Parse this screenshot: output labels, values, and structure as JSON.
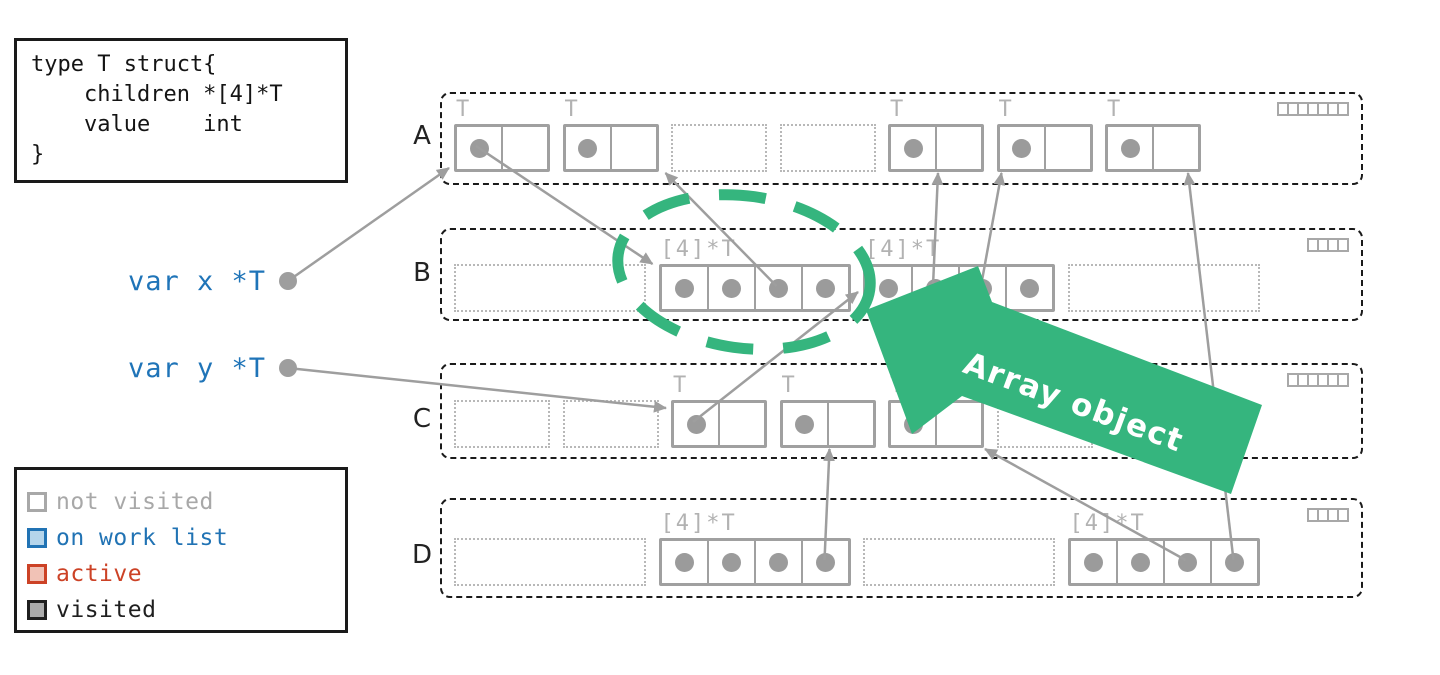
{
  "code_box": {
    "lines": [
      "type T struct{",
      "    children *[4]*T",
      "    value    int",
      "}"
    ]
  },
  "variables": [
    {
      "label": "var x *T"
    },
    {
      "label": "var y *T"
    }
  ],
  "legend": {
    "items": [
      {
        "label": "not visited",
        "box_border": "#a8a8a8",
        "box_fill": "#ffffff",
        "text_color": "#a8a8a8"
      },
      {
        "label": "on work list",
        "box_border": "#2173b4",
        "box_fill": "#b5d5eb",
        "text_color": "#2173b4"
      },
      {
        "label": "active",
        "box_border": "#cc4226",
        "box_fill": "#f1c2b6",
        "text_color": "#cc4226"
      },
      {
        "label": "visited",
        "box_border": "#1f1f1f",
        "box_fill": "#ababab",
        "text_color": "#1f1f1f"
      }
    ]
  },
  "heap": {
    "regions": [
      {
        "name": "A",
        "bitmap_cells": 7,
        "slots": [
          {
            "kind": "object",
            "type_label": "T",
            "cells": 2,
            "pointers": [
              0
            ]
          },
          {
            "kind": "object",
            "type_label": "T",
            "cells": 2,
            "pointers": [
              0
            ]
          },
          {
            "kind": "free",
            "cells": 2
          },
          {
            "kind": "free",
            "cells": 2
          },
          {
            "kind": "object",
            "type_label": "T",
            "cells": 2,
            "pointers": [
              0
            ]
          },
          {
            "kind": "object",
            "type_label": "T",
            "cells": 2,
            "pointers": [
              0
            ]
          },
          {
            "kind": "object",
            "type_label": "T",
            "cells": 2,
            "pointers": [
              0
            ]
          }
        ]
      },
      {
        "name": "B",
        "bitmap_cells": 4,
        "slots": [
          {
            "kind": "free",
            "cells": 4
          },
          {
            "kind": "object",
            "type_label": "[4]*T",
            "cells": 4,
            "pointers": [
              0,
              1,
              2,
              3
            ]
          },
          {
            "kind": "object",
            "type_label": "[4]*T",
            "cells": 4,
            "pointers": [
              0,
              1,
              2,
              3
            ]
          },
          {
            "kind": "free",
            "cells": 4
          }
        ]
      },
      {
        "name": "C",
        "bitmap_cells": 6,
        "slots": [
          {
            "kind": "free",
            "cells": 2
          },
          {
            "kind": "free",
            "cells": 2
          },
          {
            "kind": "object",
            "type_label": "T",
            "cells": 2,
            "pointers": [
              0
            ]
          },
          {
            "kind": "object",
            "type_label": "T",
            "cells": 2,
            "pointers": [
              0
            ]
          },
          {
            "kind": "object",
            "type_label": "T",
            "cells": 2,
            "pointers": [
              0
            ]
          },
          {
            "kind": "free",
            "cells": 2
          }
        ]
      },
      {
        "name": "D",
        "bitmap_cells": 4,
        "slots": [
          {
            "kind": "free",
            "cells": 4
          },
          {
            "kind": "object",
            "type_label": "[4]*T",
            "cells": 4,
            "pointers": [
              0,
              1,
              2,
              3
            ]
          },
          {
            "kind": "free",
            "cells": 4
          },
          {
            "kind": "object",
            "type_label": "[4]*T",
            "cells": 4,
            "pointers": [
              0,
              1,
              2,
              3
            ]
          }
        ]
      }
    ]
  },
  "edges": [
    {
      "from": {
        "var": 0
      },
      "to": {
        "region": "A",
        "slot": 0,
        "side": "left-bottom"
      }
    },
    {
      "from": {
        "var": 1
      },
      "to": {
        "region": "C",
        "slot": 2,
        "side": "left-upper"
      }
    },
    {
      "from": {
        "region": "A",
        "slot": 0,
        "cell": 0
      },
      "to": {
        "region": "B",
        "slot": 1,
        "side": "top-left"
      }
    },
    {
      "from": {
        "region": "B",
        "slot": 1,
        "cell": 2
      },
      "to": {
        "region": "A",
        "slot": 1,
        "side": "bottom-right",
        "dx": 6
      }
    },
    {
      "from": {
        "region": "C",
        "slot": 2,
        "cell": 0
      },
      "to": {
        "region": "B",
        "slot": 2,
        "side": "left-mid"
      }
    },
    {
      "from": {
        "region": "B",
        "slot": 2,
        "cell": 1
      },
      "to": {
        "region": "A",
        "slot": 4,
        "side": "bottom-mid"
      }
    },
    {
      "from": {
        "region": "B",
        "slot": 2,
        "cell": 2
      },
      "to": {
        "region": "A",
        "slot": 5,
        "side": "bottom-left"
      }
    },
    {
      "from": {
        "region": "D",
        "slot": 1,
        "cell": 3
      },
      "to": {
        "region": "C",
        "slot": 3,
        "side": "bottom-mid"
      }
    },
    {
      "from": {
        "region": "D",
        "slot": 3,
        "cell": 2
      },
      "to": {
        "region": "C",
        "slot": 4,
        "side": "bottom-right"
      }
    },
    {
      "from": {
        "region": "D",
        "slot": 3,
        "cell": 3
      },
      "to": {
        "region": "A",
        "slot": 6,
        "side": "bottom-right",
        "dx": -14
      }
    }
  ],
  "annotation": {
    "label": "Array object",
    "color": "#35b57e"
  },
  "colors": {
    "edge_gray": "#9e9e9e",
    "object_border": "#a0a0a0",
    "type_label_gray": "#b2b2b2",
    "var_blue": "#1f74b8",
    "highlight_green": "#35b57e",
    "region_border": "#1a1a1a"
  }
}
